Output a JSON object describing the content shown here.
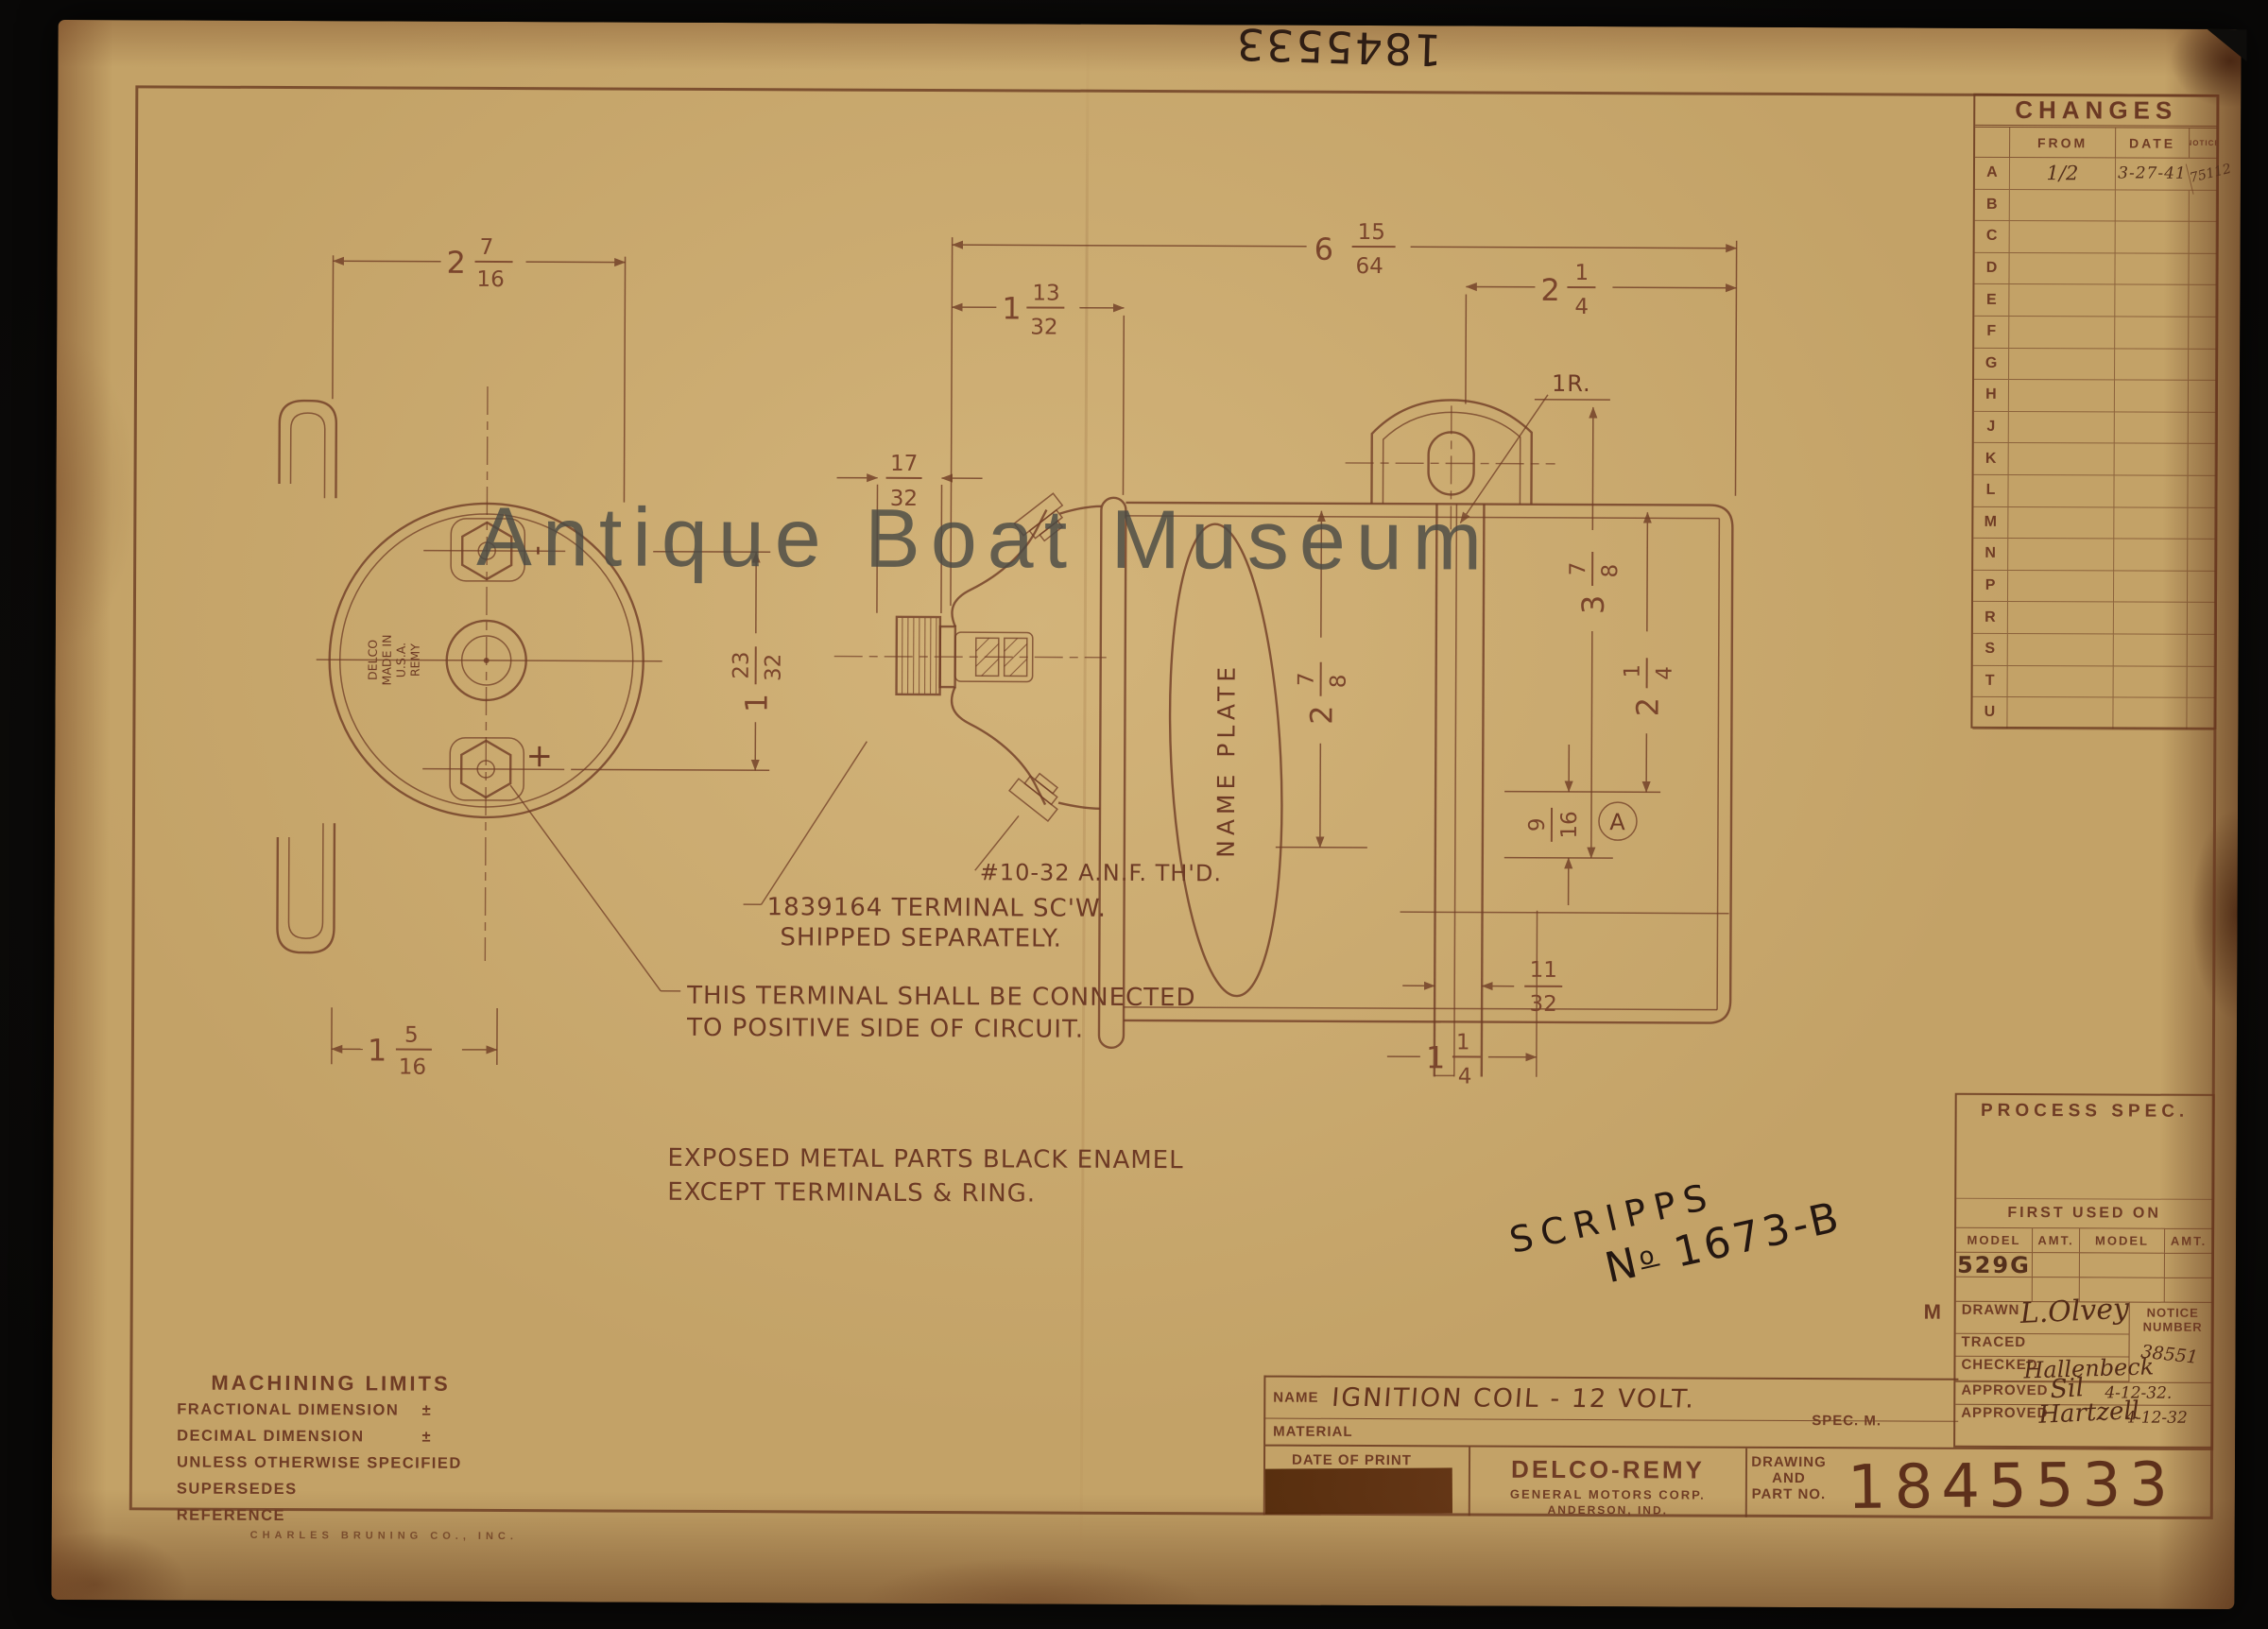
{
  "photo": {
    "background": "#0e0d0b",
    "paper": "#c3a267",
    "ink": "#6f3c25",
    "dark_ink": "#2c1b12",
    "watermark_color": "#4b4b45"
  },
  "watermark": {
    "text": "Antique Boat Museum"
  },
  "annotations": {
    "top_number": "1845533",
    "scripps_line1": "SCRIPPS",
    "scripps_n": "N",
    "scripps_o": "o",
    "scripps_number": "1673-B"
  },
  "changes_table": {
    "title": "CHANGES",
    "col_from": "FROM",
    "col_date": "DATE",
    "col_notice": "NOTICE",
    "rows": [
      {
        "letter": "A",
        "from": "1/2",
        "date": "3-27-41",
        "notice": "75112"
      },
      {
        "letter": "B"
      },
      {
        "letter": "C"
      },
      {
        "letter": "D"
      },
      {
        "letter": "E"
      },
      {
        "letter": "F"
      },
      {
        "letter": "G"
      },
      {
        "letter": "H"
      },
      {
        "letter": "J"
      },
      {
        "letter": "K"
      },
      {
        "letter": "L"
      },
      {
        "letter": "M"
      },
      {
        "letter": "N"
      },
      {
        "letter": "P"
      },
      {
        "letter": "R"
      },
      {
        "letter": "S"
      },
      {
        "letter": "T"
      },
      {
        "letter": "U"
      }
    ]
  },
  "drawing": {
    "dims": {
      "left_width": {
        "w": "2",
        "n": "7",
        "d": "16"
      },
      "bracket_width": {
        "w": "1",
        "n": "5",
        "d": "16"
      },
      "terminal_spacing": {
        "w": "1",
        "n": "23",
        "d": "32"
      },
      "knurl": {
        "n": "17",
        "d": "32"
      },
      "overall": {
        "w": "6",
        "n": "15",
        "d": "64"
      },
      "tower": {
        "w": "1",
        "n": "13",
        "d": "32"
      },
      "bracket_offset": {
        "w": "2",
        "n": "1",
        "d": "4"
      },
      "radius": "1R.",
      "height": {
        "w": "3",
        "n": "7",
        "d": "8"
      },
      "body": {
        "w": "2",
        "n": "1",
        "d": "4"
      },
      "plate": {
        "w": "2",
        "n": "7",
        "d": "8"
      },
      "slot": {
        "n": "9",
        "d": "16"
      },
      "marker": "A",
      "strap": {
        "n": "11",
        "d": "32"
      },
      "base": {
        "w": "1",
        "n": "1",
        "d": "4"
      }
    },
    "labels": {
      "nameplate": "NAME PLATE",
      "hub1": "DELCO",
      "hub2": "MADE IN",
      "hub3": "U.S.A.",
      "hub4": "REMY",
      "plus": "+",
      "minus": "-"
    },
    "notes": {
      "thread": "#10-32 A.N.F. TH'D.",
      "screw1": "1839164 TERMINAL SC'W.",
      "screw2": "SHIPPED SEPARATELY.",
      "positive1": "THIS TERMINAL SHALL BE CONNECTED",
      "positive2": "TO POSITIVE SIDE OF CIRCUIT.",
      "enamel1": "EXPOSED METAL PARTS BLACK ENAMEL",
      "enamel2": "EXCEPT TERMINALS & RING."
    }
  },
  "process_spec": {
    "title": "PROCESS SPEC.",
    "first_used_on": "FIRST USED ON",
    "col_model": "MODEL",
    "col_amt": "AMT.",
    "model_value": "529G",
    "drawn_label": "DRAWN",
    "drawn_value": "L.Olvey",
    "traced_label": "TRACED",
    "checked_label": "CHECKED",
    "checked_value": "Hallenbeck",
    "notice_label1": "NOTICE",
    "notice_label2": "NUMBER",
    "notice_value": "38551",
    "approved_label": "APPROVED",
    "approved1_value": "Sil",
    "approved1_date": "4-12-32.",
    "approved2_value": "Hartzell",
    "approved2_date": "4-12-32",
    "margin_letter": "M"
  },
  "title_block": {
    "name_label": "NAME",
    "name_value": "IGNITION COIL - 12 VOLT.",
    "material_label": "MATERIAL",
    "spec_label": "SPEC. M.",
    "date_of_print": "DATE OF PRINT",
    "company": "DELCO-REMY",
    "company_line2": "GENERAL MOTORS CORP.",
    "company_line3": "ANDERSON, IND.",
    "drawing_and1": "DRAWING",
    "drawing_and2": "AND",
    "drawing_and3": "PART NO.",
    "part_number": "1845533"
  },
  "machining": {
    "title": "MACHINING LIMITS",
    "line1": "FRACTIONAL DIMENSION",
    "pm1": "±",
    "line2": "DECIMAL DIMENSION",
    "pm2": "±",
    "line3": "UNLESS OTHERWISE SPECIFIED",
    "line4": "SUPERSEDES",
    "line5": "REFERENCE",
    "printer": "CHARLES BRUNING CO., INC."
  }
}
